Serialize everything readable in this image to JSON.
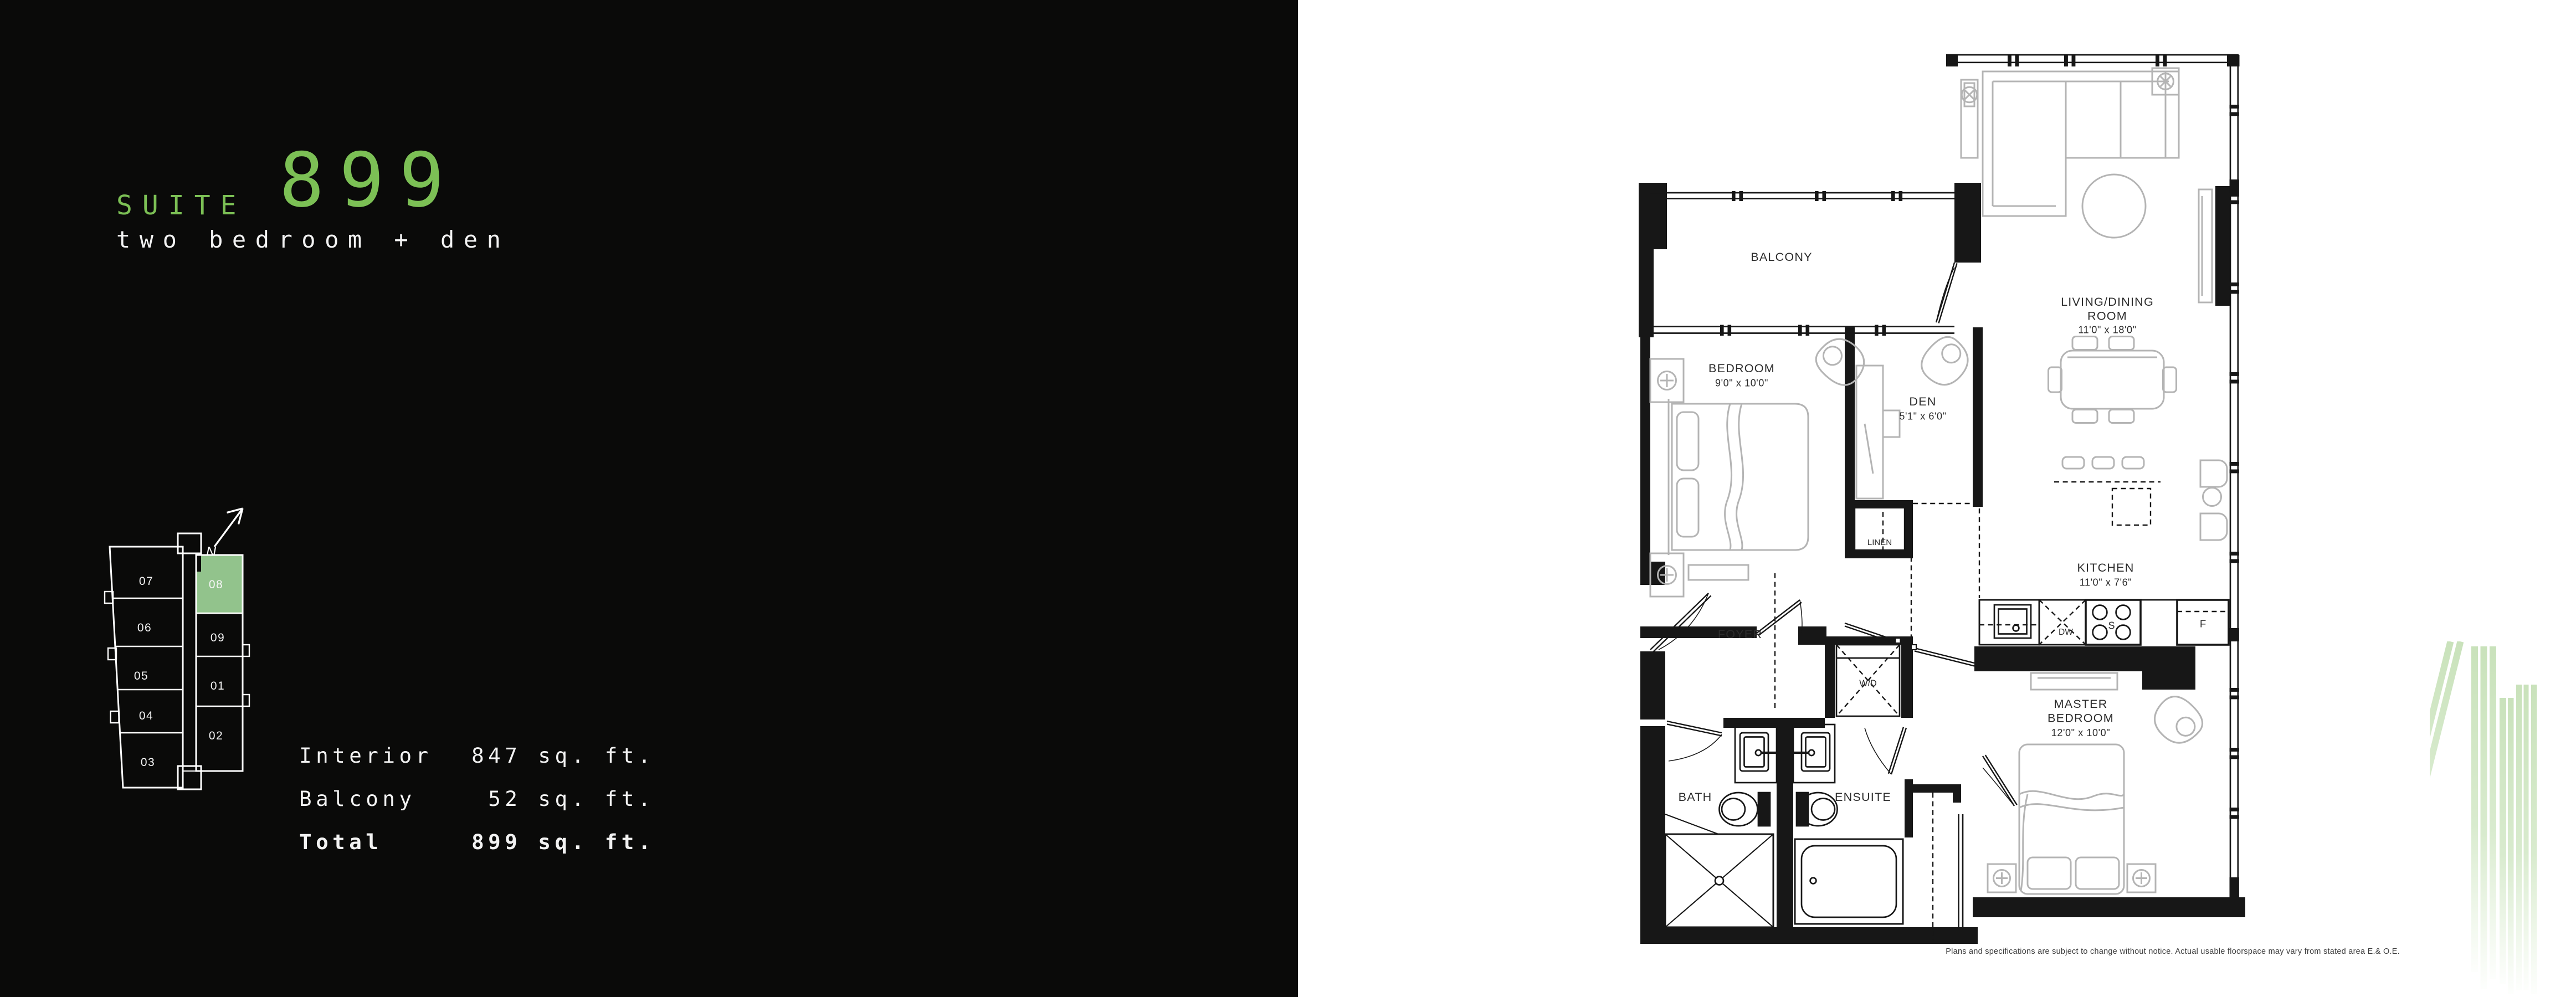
{
  "brand": {
    "accent_green": "#7cc055",
    "keyplan_highlight_green": "#92c38c",
    "decor_line_green": "#cde4c0",
    "panel_black": "#0a0a09"
  },
  "header": {
    "suite_label": "SUITE",
    "suite_number": "899",
    "suite_type": "two bedroom + den"
  },
  "area_table": {
    "rows": [
      {
        "label": "Interior",
        "value": "847 sq. ft."
      },
      {
        "label": "Balcony",
        "value": "52 sq. ft."
      },
      {
        "label": "Total",
        "value": "899 sq. ft."
      }
    ]
  },
  "keyplan": {
    "north": "N",
    "highlighted_unit": "08",
    "units": {
      "u07": "07",
      "u06": "06",
      "u05": "05",
      "u04": "04",
      "u03": "03",
      "u08": "08",
      "u09": "09",
      "u01": "01",
      "u02": "02"
    }
  },
  "floorplan": {
    "balcony": "BALCONY",
    "living": {
      "l1": "LIVING/DINING",
      "l2": "ROOM",
      "dims": "11'0\" x 18'0\""
    },
    "bedroom": {
      "l1": "BEDROOM",
      "dims": "9'0\" x 10'0\""
    },
    "den": {
      "l1": "DEN",
      "dims": "5'1\" x 6'0\""
    },
    "kitchen": {
      "l1": "KITCHEN",
      "dims": "11'0\" x 7'6\""
    },
    "master": {
      "l1": "MASTER",
      "l2": "BEDROOM",
      "dims": "12'0\" x 10'0\""
    },
    "foyer": "FOYER",
    "bath": "BATH",
    "ensuite": "ENSUITE",
    "linen": "LINEN",
    "wd": "W/D",
    "appliances": {
      "dw": "DW",
      "stove": "S",
      "fridge": "F"
    }
  },
  "disclaimer": "Plans and specifications are subject to change without notice.  Actual usable floorspace may vary from stated area E.& O.E."
}
